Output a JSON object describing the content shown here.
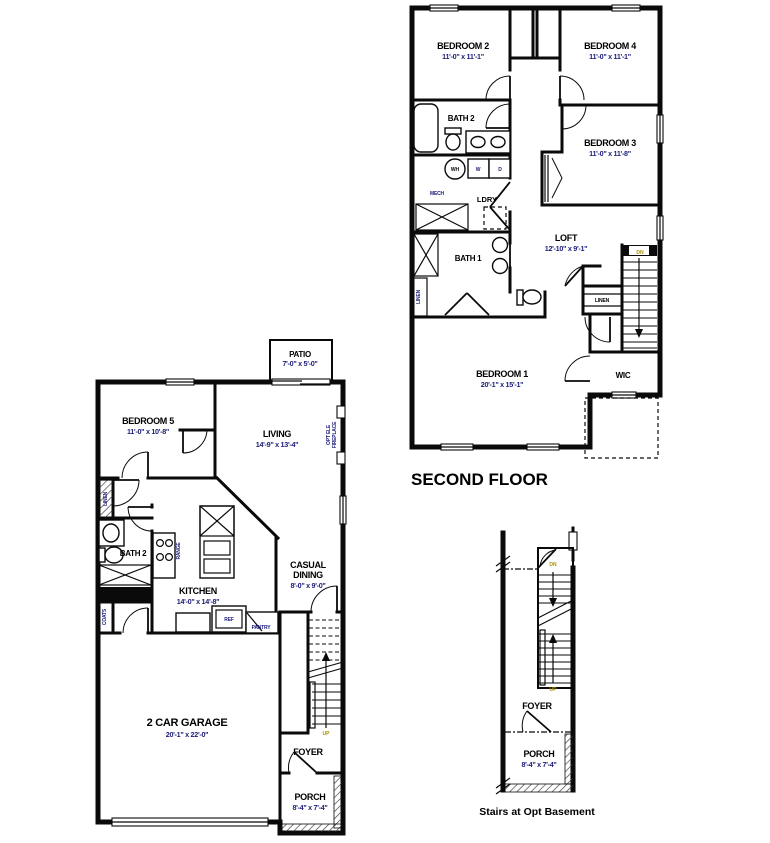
{
  "colors": {
    "wall": "#0a0a0a",
    "room_name": "#000000",
    "dimension": "#1b1b78",
    "small_label": "#1b1b78",
    "up_down": "#a98f00"
  },
  "second_floor": {
    "title": "SECOND FLOOR",
    "bedroom2": {
      "name": "BEDROOM 2",
      "dims": "11'-0\" x 11'-1\""
    },
    "bedroom4": {
      "name": "BEDROOM 4",
      "dims": "11'-0\" x 11'-1\""
    },
    "bedroom3": {
      "name": "BEDROOM 3",
      "dims": "11'-0\" x 11'-8\""
    },
    "bath2": "BATH 2",
    "water_heater": "WH",
    "washer": "W",
    "dryer": "D",
    "mech": "MECH",
    "laundry": "LDRY",
    "bath1": "BATH 1",
    "linen_closet": "LINEN",
    "loft": {
      "name": "LOFT",
      "dims": "12'-10\" x 9'-1\""
    },
    "linen_stairs": "LINEN",
    "dn": "DN",
    "bedroom1": {
      "name": "BEDROOM 1",
      "dims": "20'-1\" x 15'-1\""
    },
    "wic": "WIC"
  },
  "first_floor": {
    "patio": {
      "name": "PATIO",
      "dims": "7'-0\" x 5'-0\""
    },
    "bedroom5": {
      "name": "BEDROOM 5",
      "dims": "11'-0\" x 10'-8\""
    },
    "living": {
      "name": "LIVING",
      "dims": "14'-9\" x 13'-4\""
    },
    "fireplace": {
      "line1": "OPT ELE",
      "line2": "FIREPLACE"
    },
    "linen": "LINEN",
    "bath2": "BATH 2",
    "range": "RANGE",
    "kitchen": {
      "name": "KITCHEN",
      "dims": "14'-0\" x 14'-8\""
    },
    "ref": "REF",
    "pantry": "PANTRY",
    "casual_dining": {
      "line1": "CASUAL",
      "line2": "DINING",
      "dims": "8'-0\" x 9'-0\""
    },
    "coats": "COATS",
    "garage": {
      "name": "2 CAR GARAGE",
      "dims": "20'-1\" x 22'-0\""
    },
    "up": "UP",
    "foyer": "FOYER",
    "porch": {
      "name": "PORCH",
      "dims": "8'-4\" x 7'-4\""
    }
  },
  "stairs_detail": {
    "dn": "DN",
    "up": "UP",
    "foyer": "FOYER",
    "porch": {
      "name": "PORCH",
      "dims": "8'-4\" x 7'-4\""
    },
    "caption": "Stairs at Opt Basement"
  }
}
